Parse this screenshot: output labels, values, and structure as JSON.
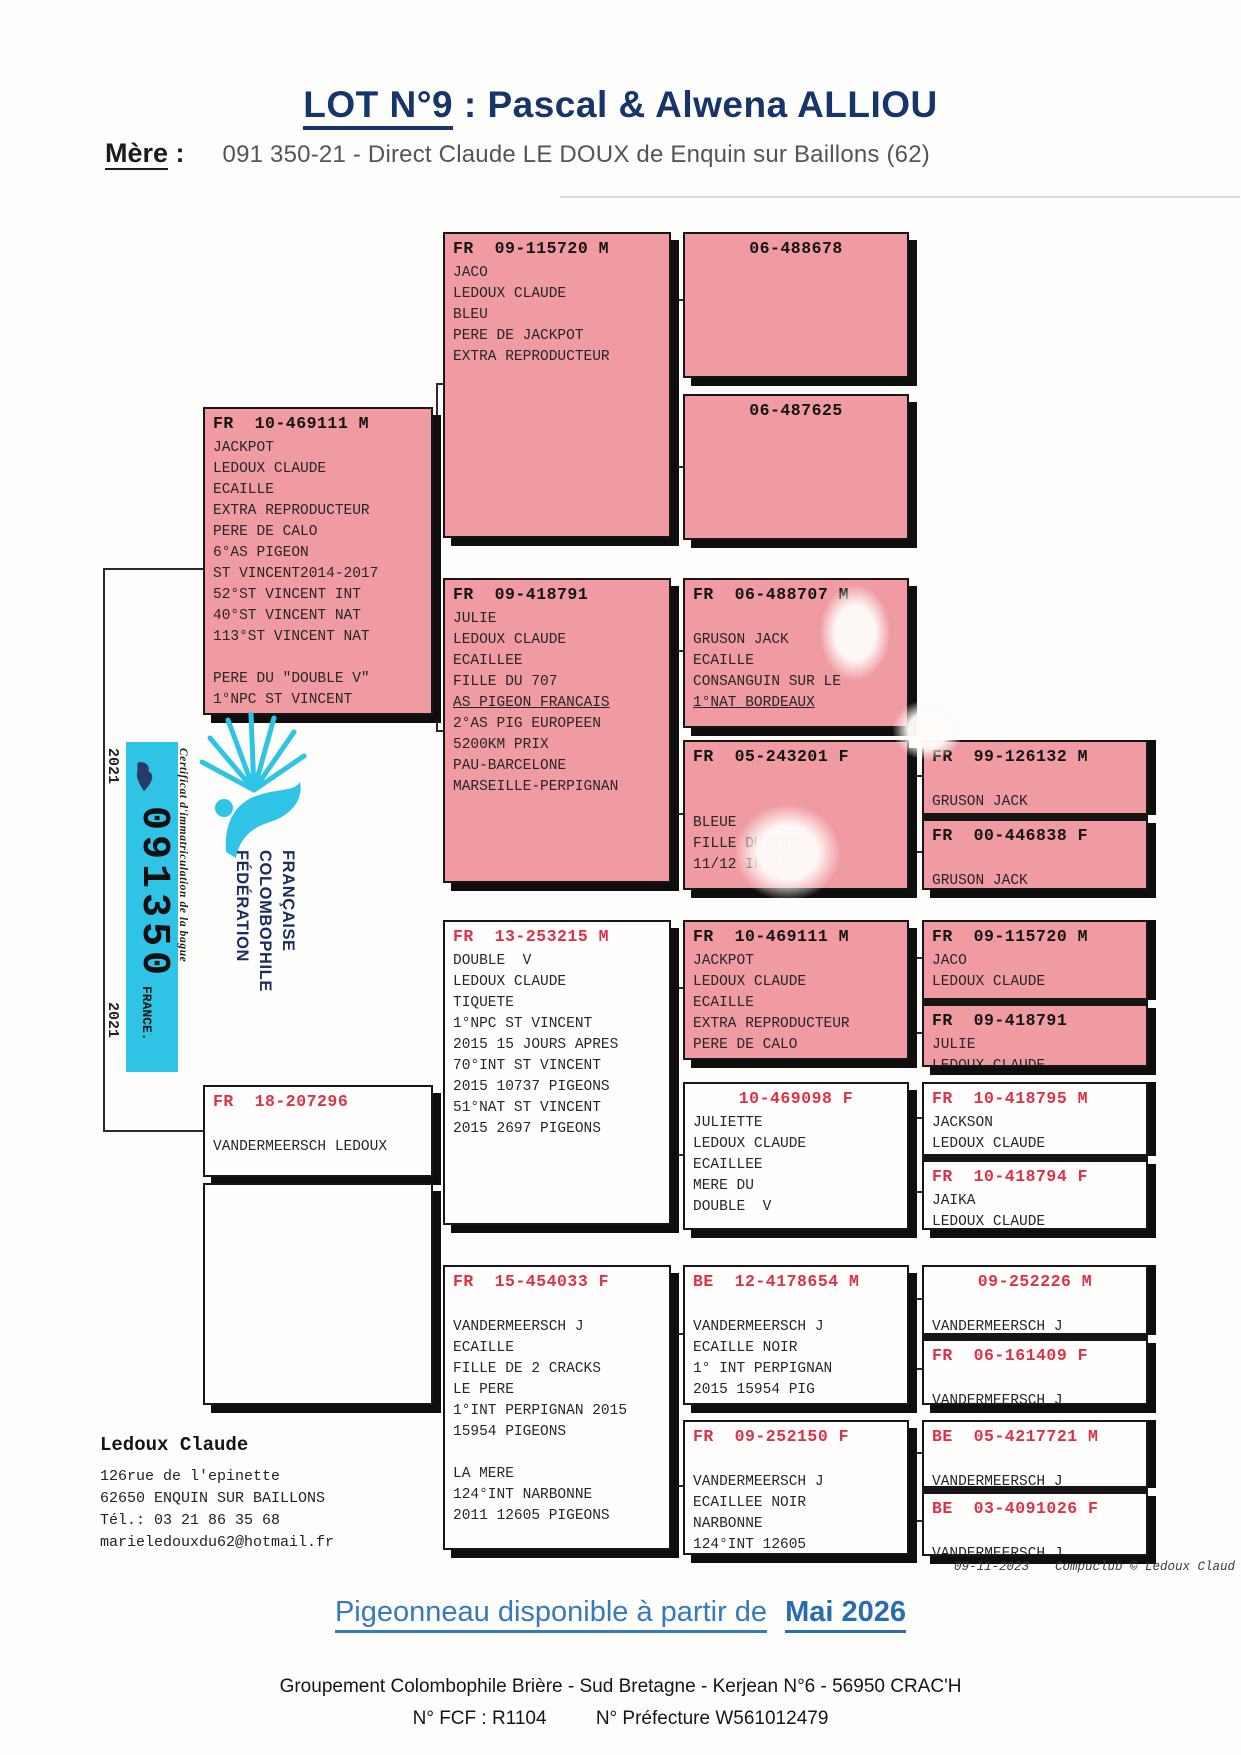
{
  "page": {
    "title_lot": "LOT N°9",
    "title_rest": " : Pascal & Alwena ALLIOU",
    "mother_label": "Mère",
    "mother_colon": ":",
    "mother_value": "091 350-21 - Direct Claude LE DOUX de Enquin sur Baillons (62)"
  },
  "colors": {
    "box_pink": "#f09aa2",
    "header_red": "#dc3247",
    "navy": "#17356b",
    "footer_blue": "#2f74b8",
    "band_cyan": "#2fc3e6"
  },
  "certificate": {
    "year_top": "2021",
    "year_bottom": "2021",
    "ring_number": "091350",
    "country": "FRANCE.",
    "label": "Certificat d'immatriculation de la bague",
    "federation": "FÉDÉRATION COLOMBOPHILE FRANÇAISE"
  },
  "pedigree": {
    "underlined_lines": [
      "AS PIGEON FRANCAIS",
      "1°NAT BORDEAUX"
    ],
    "boxes": [
      {
        "ring": "FR  09-115720 M",
        "variant": "pink",
        "header": "black",
        "center": false,
        "x": 443,
        "y": 232,
        "w": 228,
        "h": 306,
        "stack": null,
        "lines": [
          "JACO",
          "LEDOUX CLAUDE",
          "BLEU",
          "PERE DE JACKPOT",
          "EXTRA REPRODUCTEUR"
        ]
      },
      {
        "ring": "06-488678",
        "variant": "pink",
        "header": "black",
        "center": true,
        "x": 683,
        "y": 232,
        "w": 226,
        "h": 146,
        "stack": null,
        "lines": []
      },
      {
        "ring": "06-487625",
        "variant": "pink",
        "header": "black",
        "center": true,
        "x": 683,
        "y": 394,
        "w": 226,
        "h": 146,
        "stack": null,
        "lines": []
      },
      {
        "ring": "FR  10-469111 M",
        "variant": "pink",
        "header": "black",
        "center": false,
        "x": 203,
        "y": 407,
        "w": 230,
        "h": 308,
        "stack": null,
        "lines": [
          "JACKPOT",
          "LEDOUX CLAUDE",
          "ECAILLE",
          "EXTRA REPRODUCTEUR",
          "PERE DE CALO",
          "6°AS PIGEON",
          "ST VINCENT2014-2017",
          "52°ST VINCENT INT",
          "40°ST VINCENT NAT",
          "113°ST VINCENT NAT",
          "",
          "PERE DU \"DOUBLE V\"",
          "1°NPC ST VINCENT"
        ]
      },
      {
        "ring": "FR  09-418791",
        "variant": "pink",
        "header": "black",
        "center": false,
        "x": 443,
        "y": 578,
        "w": 228,
        "h": 305,
        "stack": null,
        "lines": [
          "JULIE",
          "LEDOUX CLAUDE",
          "ECAILLEE",
          "FILLE DU 707",
          "AS PIGEON FRANCAIS",
          "2°AS PIG EUROPEEN",
          "5200KM PRIX",
          "PAU-BARCELONE",
          "MARSEILLE-PERPIGNAN"
        ]
      },
      {
        "ring": "FR  06-488707 M",
        "variant": "pink",
        "header": "black",
        "center": false,
        "x": 683,
        "y": 578,
        "w": 226,
        "h": 150,
        "stack": null,
        "lines": [
          "",
          "GRUSON JACK",
          "ECAILLE",
          "CONSANGUIN SUR LE",
          "1°NAT BORDEAUX"
        ]
      },
      {
        "ring": "FR  05-243201 F",
        "variant": "pink",
        "header": "black",
        "center": false,
        "x": 683,
        "y": 740,
        "w": 226,
        "h": 150,
        "stack": null,
        "lines": [
          "",
          "",
          "BLEUE",
          "FILLE DU 132",
          "11/12 INTER"
        ]
      },
      {
        "ring": "FR  99-126132 M",
        "variant": "pink",
        "header": "black",
        "center": false,
        "x": 922,
        "y": 740,
        "w": 226,
        "h": 75,
        "stack": "top",
        "lines": [
          "",
          "GRUSON JACK"
        ]
      },
      {
        "ring": "FR  00-446838 F",
        "variant": "pink",
        "header": "black",
        "center": false,
        "x": 922,
        "y": 815,
        "w": 226,
        "h": 75,
        "stack": "bottom",
        "lines": [
          "",
          "GRUSON JACK"
        ]
      },
      {
        "ring": "FR  13-253215 M",
        "variant": "white",
        "header": "red",
        "center": false,
        "x": 443,
        "y": 920,
        "w": 228,
        "h": 305,
        "stack": null,
        "lines": [
          "DOUBLE  V",
          "LEDOUX CLAUDE",
          "TIQUETE",
          "1°NPC ST VINCENT",
          "2015 15 JOURS APRES",
          "70°INT ST VINCENT",
          "2015 10737 PIGEONS",
          "51°NAT ST VINCENT",
          "2015 2697 PIGEONS"
        ]
      },
      {
        "ring": "FR  10-469111 M",
        "variant": "pink",
        "header": "black",
        "center": false,
        "x": 683,
        "y": 920,
        "w": 226,
        "h": 140,
        "stack": null,
        "lines": [
          "JACKPOT",
          "LEDOUX CLAUDE",
          "ECAILLE",
          "EXTRA REPRODUCTEUR",
          "PERE DE CALO"
        ]
      },
      {
        "ring": "FR  09-115720 M",
        "variant": "pink",
        "header": "black",
        "center": false,
        "x": 922,
        "y": 920,
        "w": 226,
        "h": 80,
        "stack": "top",
        "lines": [
          "JACO",
          "LEDOUX CLAUDE"
        ]
      },
      {
        "ring": "FR  09-418791",
        "variant": "pink",
        "header": "black",
        "center": false,
        "x": 922,
        "y": 1000,
        "w": 226,
        "h": 67,
        "stack": "bottom",
        "lines": [
          "JULIE",
          "LEDOUX CLAUDE"
        ]
      },
      {
        "ring": "10-469098 F",
        "variant": "white",
        "header": "red",
        "center": true,
        "x": 683,
        "y": 1082,
        "w": 226,
        "h": 148,
        "stack": null,
        "lines": [
          "JULIETTE",
          "LEDOUX CLAUDE",
          "ECAILLEE",
          "MERE DU",
          "DOUBLE  V"
        ]
      },
      {
        "ring": "FR  10-418795 M",
        "variant": "white",
        "header": "red",
        "center": false,
        "x": 922,
        "y": 1082,
        "w": 226,
        "h": 74,
        "stack": "top",
        "lines": [
          "JACKSON",
          "LEDOUX CLAUDE"
        ]
      },
      {
        "ring": "FR  10-418794 F",
        "variant": "white",
        "header": "red",
        "center": false,
        "x": 922,
        "y": 1156,
        "w": 226,
        "h": 74,
        "stack": "bottom",
        "lines": [
          "JAIKA",
          "LEDOUX CLAUDE"
        ]
      },
      {
        "ring": "FR  18-207296",
        "variant": "white",
        "header": "red",
        "center": false,
        "x": 203,
        "y": 1085,
        "w": 230,
        "h": 92,
        "stack": null,
        "lines": [
          "",
          "VANDERMEERSCH LEDOUX"
        ]
      },
      {
        "ring": "",
        "variant": "white",
        "header": "black",
        "center": false,
        "x": 203,
        "y": 1183,
        "w": 230,
        "h": 222,
        "stack": null,
        "lines": []
      },
      {
        "ring": "FR  15-454033 F",
        "variant": "white",
        "header": "red",
        "center": false,
        "x": 443,
        "y": 1265,
        "w": 228,
        "h": 285,
        "stack": null,
        "lines": [
          "",
          "VANDERMEERSCH J",
          "ECAILLE",
          "FILLE DE 2 CRACKS",
          "LE PERE",
          "1°INT PERPIGNAN 2015",
          "15954 PIGEONS",
          "",
          "LA MERE",
          "124°INT NARBONNE",
          "2011 12605 PIGEONS"
        ]
      },
      {
        "ring": "BE  12-4178654 M",
        "variant": "white",
        "header": "red",
        "center": false,
        "x": 683,
        "y": 1265,
        "w": 226,
        "h": 140,
        "stack": null,
        "lines": [
          "",
          "VANDERMEERSCH J",
          "ECAILLE NOIR",
          "1° INT PERPIGNAN",
          "2015 15954 PIG"
        ]
      },
      {
        "ring": "09-252226 M",
        "variant": "white",
        "header": "red",
        "center": true,
        "x": 922,
        "y": 1265,
        "w": 226,
        "h": 70,
        "stack": "top",
        "lines": [
          "",
          "VANDERMEERSCH J"
        ]
      },
      {
        "ring": "FR  06-161409 F",
        "variant": "white",
        "header": "red",
        "center": false,
        "x": 922,
        "y": 1335,
        "w": 226,
        "h": 70,
        "stack": "bottom",
        "lines": [
          "",
          "VANDERMEERSCH J"
        ]
      },
      {
        "ring": "FR  09-252150 F",
        "variant": "white",
        "header": "red",
        "center": false,
        "x": 683,
        "y": 1420,
        "w": 226,
        "h": 135,
        "stack": null,
        "lines": [
          "",
          "VANDERMEERSCH J",
          "ECAILLEE NOIR",
          "NARBONNE",
          "124°INT 12605"
        ]
      },
      {
        "ring": "BE  05-4217721 M",
        "variant": "white",
        "header": "red",
        "center": false,
        "x": 922,
        "y": 1420,
        "w": 226,
        "h": 68,
        "stack": "top",
        "lines": [
          "",
          "VANDERMEERSCH J"
        ]
      },
      {
        "ring": "BE  03-4091026 F",
        "variant": "white",
        "header": "red",
        "center": false,
        "x": 922,
        "y": 1488,
        "w": 226,
        "h": 68,
        "stack": "bottom",
        "lines": [
          "",
          "VANDERMEERSCH J"
        ]
      }
    ]
  },
  "breeder": {
    "name": "Ledoux Claude",
    "address_line1": "126rue de l'epinette",
    "address_line2": "62650  ENQUIN SUR BAILLONS",
    "phone": "Tél.: 03 21 86 35 68",
    "email": "marieledouxdu62@hotmail.fr"
  },
  "stamp": {
    "date": "09-11-2023",
    "software": "Compuclub © Ledoux Claud"
  },
  "footer": {
    "availability_text": "Pigeonneau disponible à partir de",
    "availability_date": "Mai 2026",
    "club_line": "Groupement Colombophile Brière - Sud Bretagne - Kerjean N°6 - 56950 CRAC'H",
    "fcf": "N° FCF : R1104",
    "prefecture": "N° Préfecture W561012479"
  }
}
